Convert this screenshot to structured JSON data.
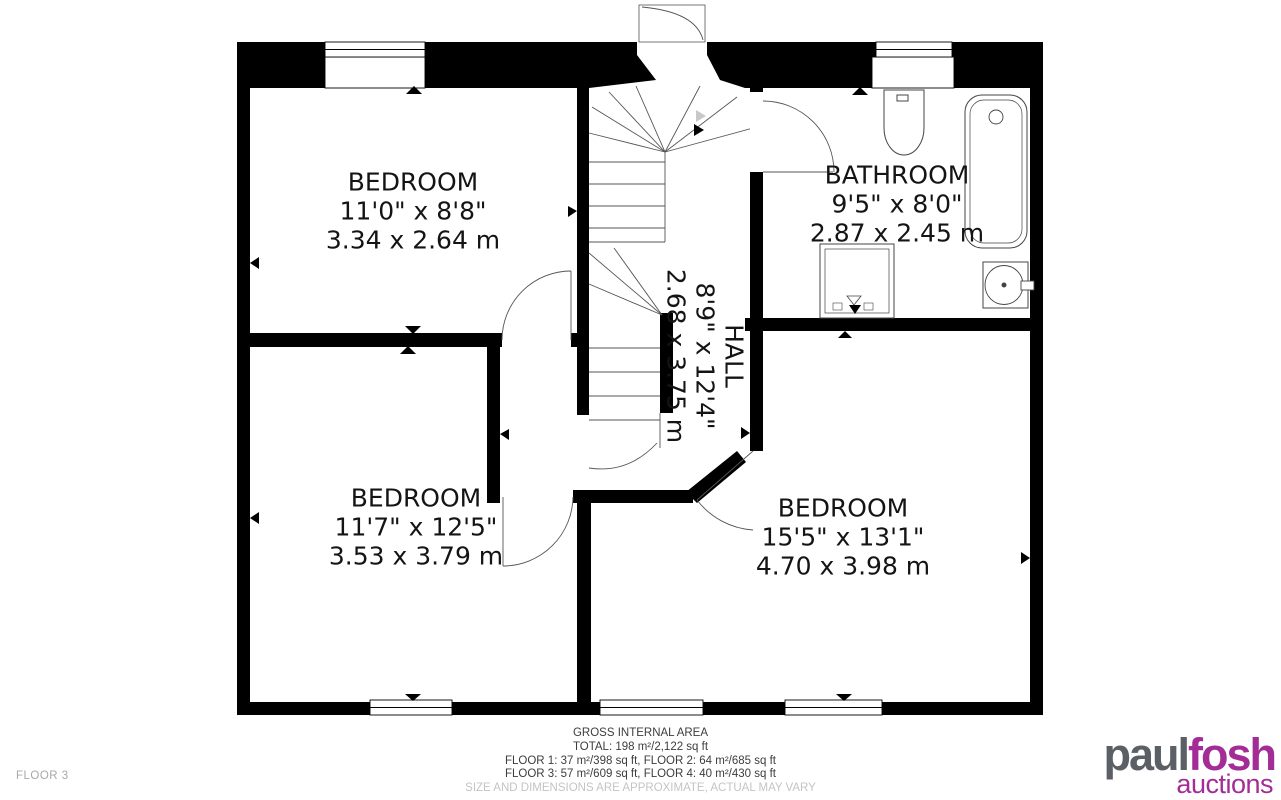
{
  "plan": {
    "floor_label": "FLOOR 3",
    "rooms": {
      "bedroom_top_left": {
        "name": "BEDROOM",
        "imperial": "11'0\" x 8'8\"",
        "metric": "3.34 x 2.64 m"
      },
      "bathroom": {
        "name": "BATHROOM",
        "imperial": "9'5\" x 8'0\"",
        "metric": "2.87 x 2.45 m"
      },
      "hall": {
        "name": "HALL",
        "imperial": "8'9\" x 12'4\"",
        "metric": "2.68 x 3.75 m"
      },
      "bedroom_bottom_left": {
        "name": "BEDROOM",
        "imperial": "11'7\" x 12'5\"",
        "metric": "3.53 x 3.79 m"
      },
      "bedroom_bottom_right": {
        "name": "BEDROOM",
        "imperial": "15'5\" x 13'1\"",
        "metric": "4.70 x 3.98 m"
      }
    },
    "area_summary": {
      "title": "GROSS INTERNAL AREA",
      "total": "TOTAL: 198 m²/2,122 sq ft",
      "floors_line_1": "FLOOR 1: 37 m²/398 sq ft, FLOOR 2: 64 m²/685 sq ft",
      "floors_line_2": "FLOOR 3: 57 m²/609 sq ft, FLOOR 4: 40 m²/430 sq ft",
      "disclaimer": "SIZE AND DIMENSIONS ARE APPROXIMATE, ACTUAL MAY VARY"
    }
  },
  "branding": {
    "logo_part_1": "paul",
    "logo_part_2": "fosh",
    "logo_tagline": "auctions",
    "color_gray": "#5b6067",
    "color_magenta": "#a42c96"
  }
}
